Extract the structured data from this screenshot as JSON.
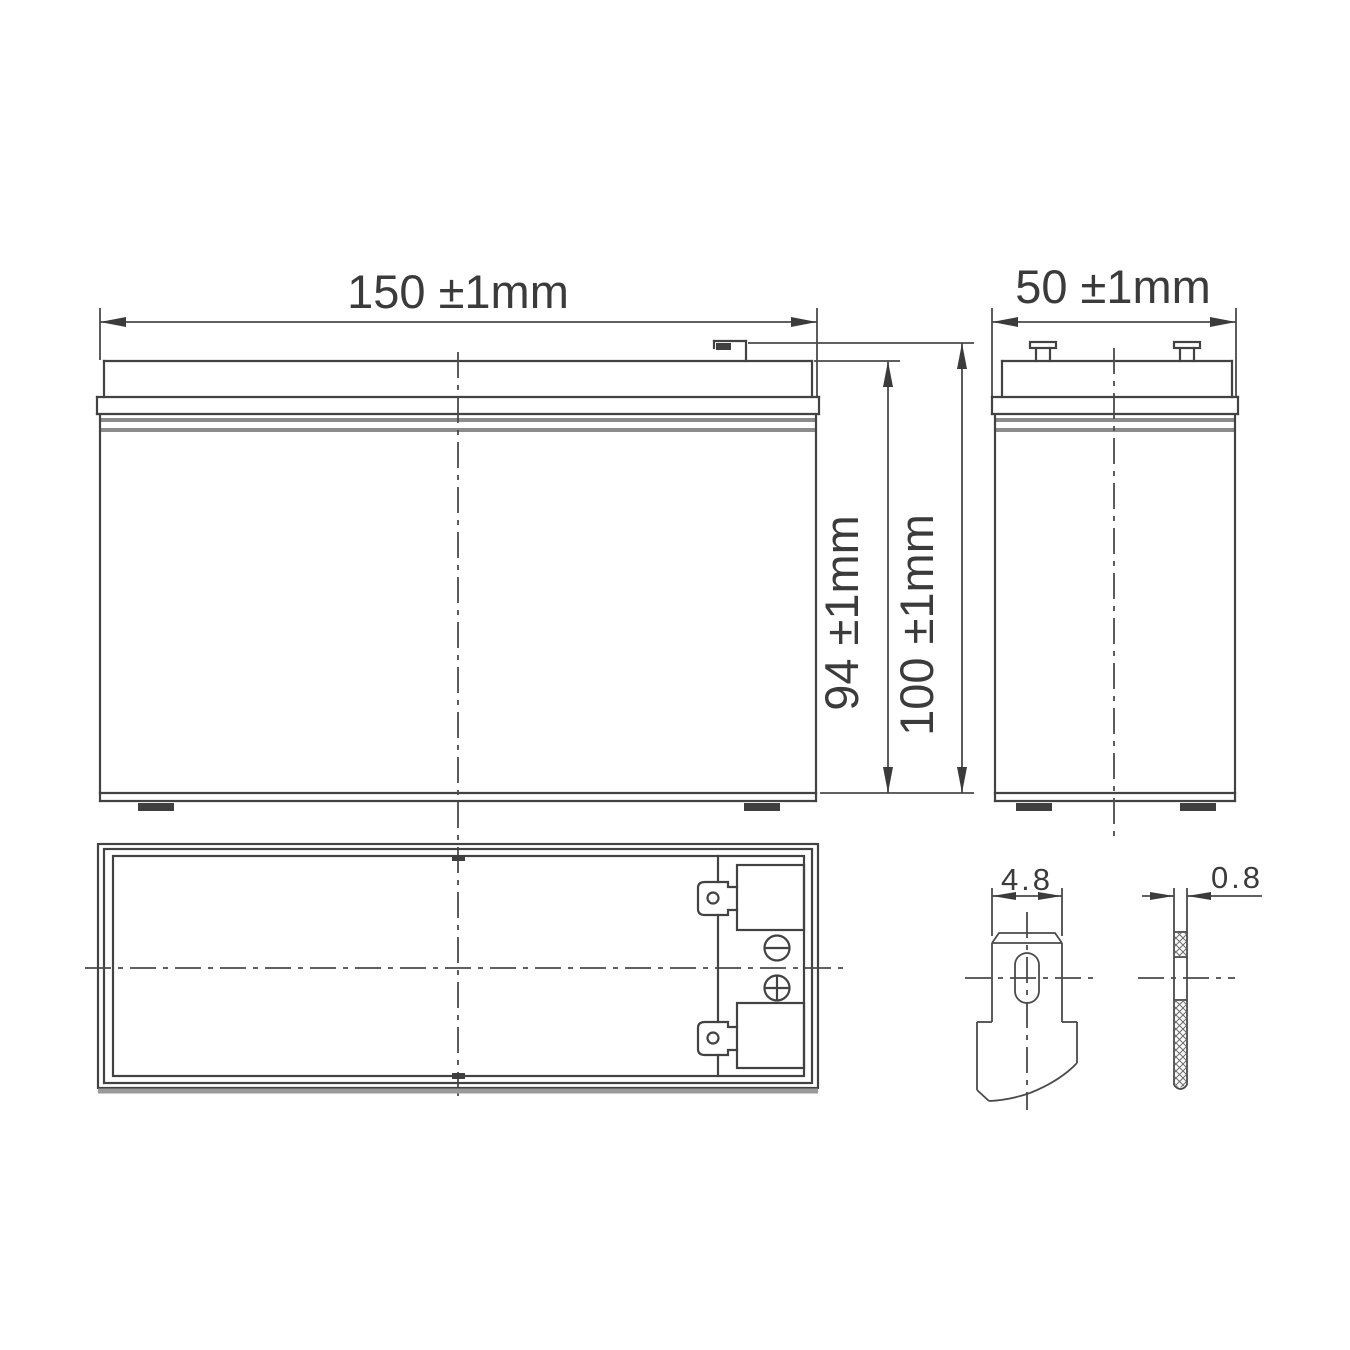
{
  "drawing": {
    "kind": "battery-outline-dimension-drawing",
    "background_color": "#ffffff",
    "line_color": "#424242",
    "light_line_color": "#8c8c8c",
    "text_color": "#3b3b3b",
    "dims": {
      "width": "150 ±1mm",
      "depth": "50 ±1mm",
      "case_height": "94 ±1mm",
      "total_height": "100 ±1mm",
      "terminal_width": "4.8",
      "terminal_thickness": "0.8"
    },
    "markers": {
      "negative": "minus-circle-icon",
      "positive": "plus-circle-icon"
    }
  }
}
